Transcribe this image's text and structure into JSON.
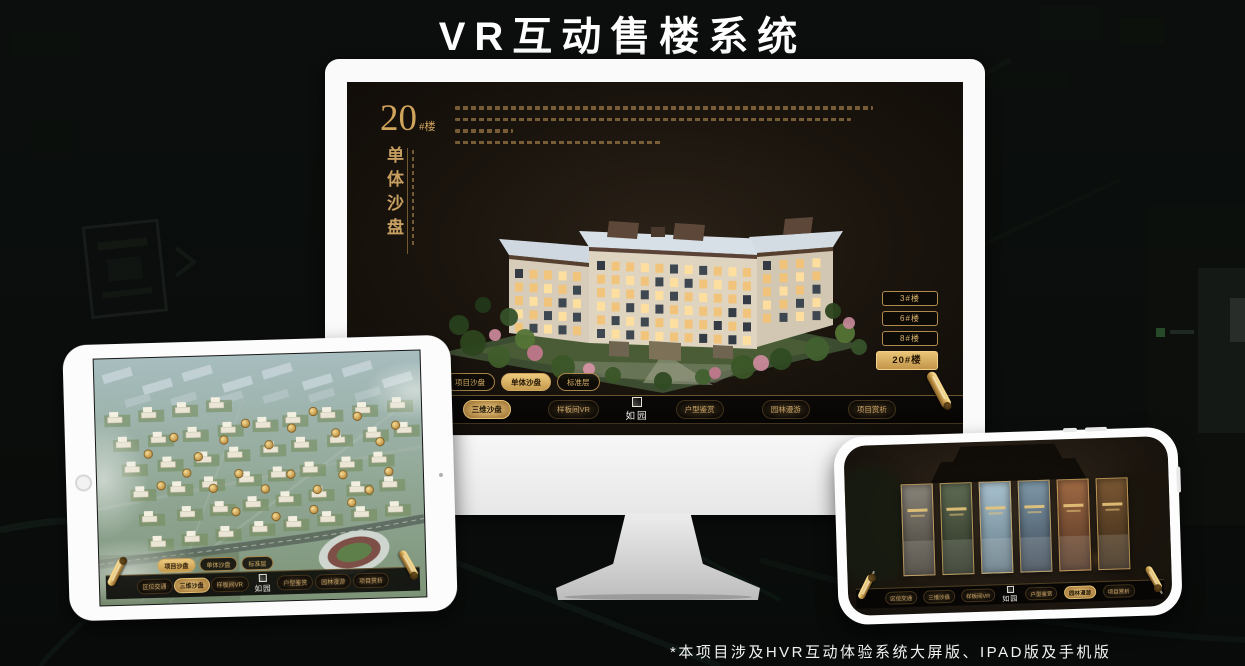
{
  "page": {
    "title": "VR互动售楼系统",
    "footnote": "*本项目涉及HVR互动体验系统大屏版、IPAD版及手机版"
  },
  "colors": {
    "gold": "#c9a063",
    "gold_bright": "#edca7e",
    "screen_bg": "#1b150e",
    "nav_bg": "#060504"
  },
  "monitor": {
    "screen": {
      "floor_title_num": "20",
      "floor_title_suffix": "#楼",
      "subtitle_vertical": "单体沙盘",
      "floor_buttons": [
        {
          "label": "3#楼",
          "selected": false
        },
        {
          "label": "6#楼",
          "selected": false
        },
        {
          "label": "8#楼",
          "selected": false
        },
        {
          "label": "20#楼",
          "selected": true
        }
      ],
      "sub_tabs": [
        {
          "label": "项目沙盘",
          "selected": false
        },
        {
          "label": "单体沙盘",
          "selected": true
        },
        {
          "label": "标准层",
          "selected": false
        }
      ],
      "nav": {
        "left_items": [
          {
            "label": "区位交通",
            "selected": false
          },
          {
            "label": "三维沙盘",
            "selected": true
          },
          {
            "label": "样板间VR",
            "selected": false
          }
        ],
        "logo": "如园",
        "right_items": [
          {
            "label": "户型鉴赏",
            "selected": false
          },
          {
            "label": "园林漫游",
            "selected": false
          },
          {
            "label": "项目赏析",
            "selected": false
          }
        ]
      }
    }
  },
  "tablet": {
    "sub_tabs": [
      {
        "label": "项目沙盘",
        "selected": true
      },
      {
        "label": "单体沙盘",
        "selected": false
      },
      {
        "label": "标准层",
        "selected": false
      }
    ],
    "nav": {
      "left_items": [
        {
          "label": "区位交通",
          "selected": false
        },
        {
          "label": "三维沙盘",
          "selected": true
        },
        {
          "label": "样板间VR",
          "selected": false
        }
      ],
      "logo": "如园",
      "right_items": [
        {
          "label": "户型鉴赏",
          "selected": false
        },
        {
          "label": "园林漫游",
          "selected": false
        },
        {
          "label": "项目赏析",
          "selected": false
        }
      ]
    },
    "badges": [
      [
        52,
        96
      ],
      [
        78,
        80
      ],
      [
        102,
        100
      ],
      [
        128,
        84
      ],
      [
        150,
        68
      ],
      [
        173,
        90
      ],
      [
        196,
        74
      ],
      [
        218,
        58
      ],
      [
        240,
        80
      ],
      [
        262,
        64
      ],
      [
        284,
        90
      ],
      [
        300,
        74
      ],
      [
        64,
        128
      ],
      [
        90,
        116
      ],
      [
        116,
        132
      ],
      [
        142,
        118
      ],
      [
        168,
        134
      ],
      [
        194,
        120
      ],
      [
        220,
        136
      ],
      [
        246,
        122
      ],
      [
        272,
        138
      ],
      [
        292,
        120
      ],
      [
        138,
        156
      ],
      [
        178,
        162
      ],
      [
        216,
        156
      ],
      [
        254,
        150
      ]
    ]
  },
  "phone": {
    "nav": {
      "left_items": [
        {
          "label": "区位交通",
          "selected": false
        },
        {
          "label": "三维沙盘",
          "selected": false
        },
        {
          "label": "样板间VR",
          "selected": false
        }
      ],
      "logo": "如园",
      "right_items": [
        {
          "label": "户型鉴赏",
          "selected": false
        },
        {
          "label": "园林漫游",
          "selected": true
        },
        {
          "label": "项目赏析",
          "selected": false
        }
      ]
    },
    "cards": [
      {
        "c1": "#8a857b",
        "c2": "#403a32"
      },
      {
        "c1": "#5f6b54",
        "c2": "#2a3122"
      },
      {
        "c1": "#a9c2cf",
        "c2": "#637a87"
      },
      {
        "c1": "#7e98a8",
        "c2": "#3e4a58"
      },
      {
        "c1": "#a06a44",
        "c2": "#513423"
      },
      {
        "c1": "#7a5733",
        "c2": "#3a2a18"
      }
    ]
  }
}
